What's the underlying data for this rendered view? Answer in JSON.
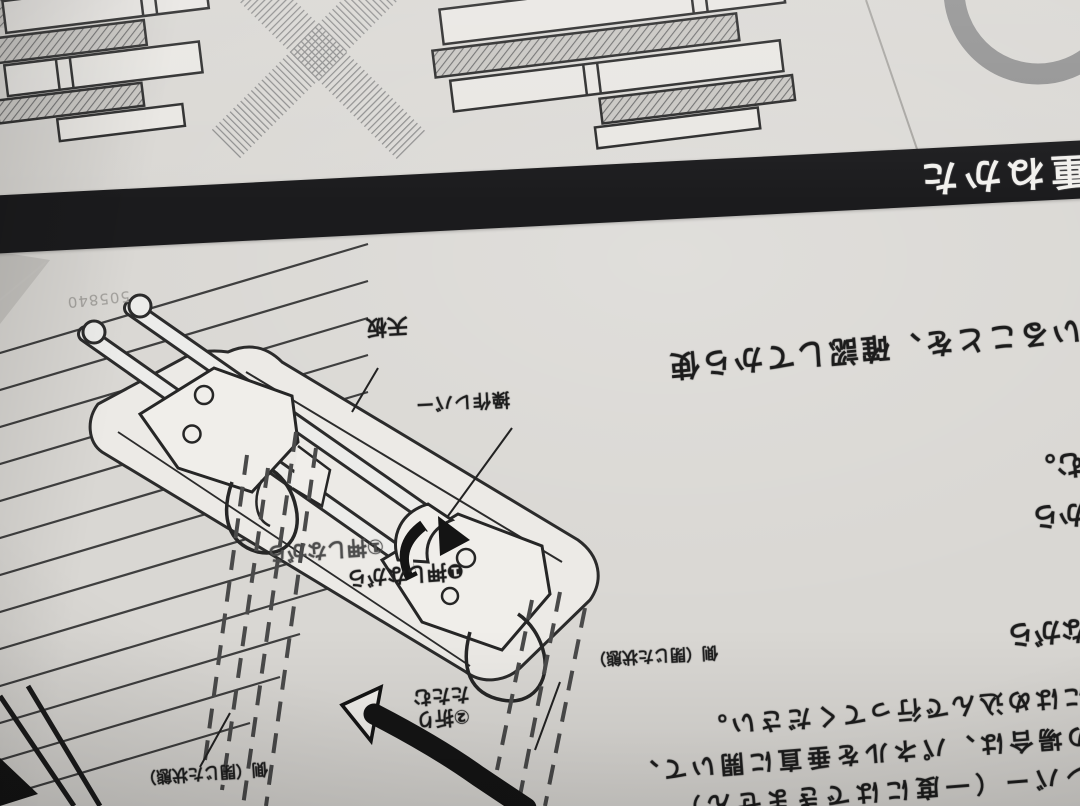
{
  "stacking_guide": {
    "cross_mark": "✕",
    "circle_mark": "〇"
  },
  "banner": {
    "title": "の重ねかた"
  },
  "sheet": {
    "serial": "505840"
  },
  "diagram_labels": {
    "top_panel": "天板",
    "operation_lever": "操作レバー",
    "step1_ghost": "①押しながら",
    "step1": "❶押しながら",
    "step2_line1": "②折り",
    "step2_line2": "たたむ",
    "side_closed_state_right": "側（閉じた状態）",
    "side_closed_state_left": "側（閉じた状態）"
  },
  "body_text": {
    "confirm_line": "いることを、確認してから使",
    "line_end_mu": "む。",
    "line_end_kara": "から",
    "line_end_nagara": "ながら",
    "paragraph_line1": "にはめ込んで行ってください。",
    "paragraph_line2": "の場合は、パネルを垂直に開いて、",
    "paragraph_line3": "レバー（一度にはできません）"
  },
  "colors": {
    "paper": "#d9d7d3",
    "banner_bg": "#1b1b1d",
    "banner_text": "#f2f1ee",
    "ink": "#1c1c1c",
    "gray_mark": "#949494"
  }
}
